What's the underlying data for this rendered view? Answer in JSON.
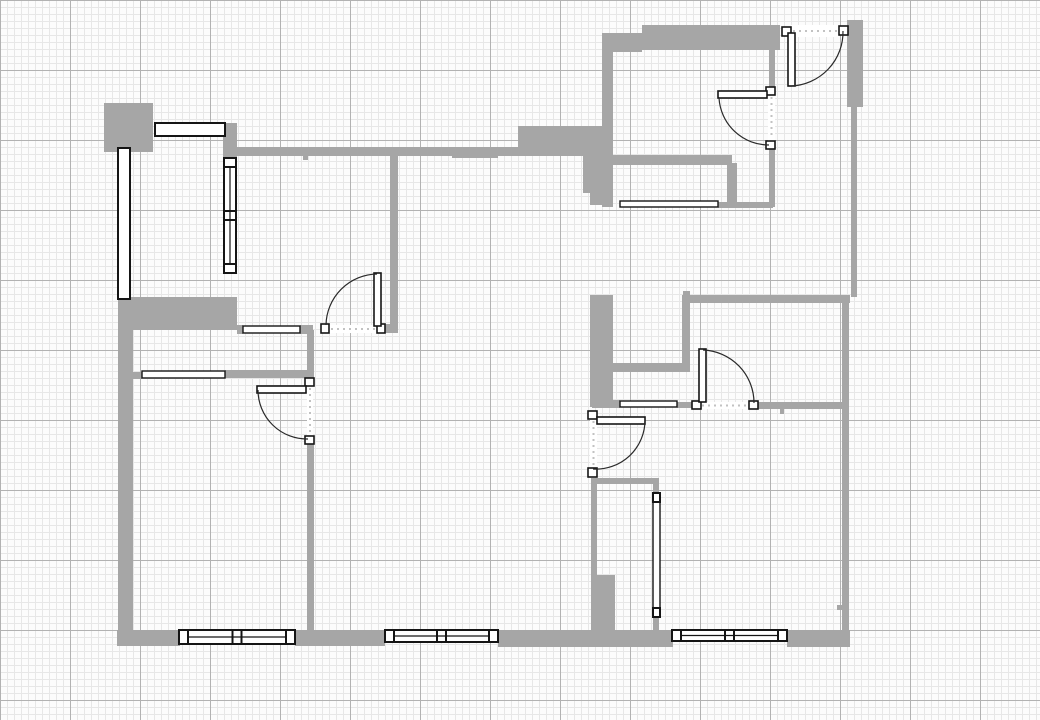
{
  "app": {
    "title": "Floor plan drawing canvas"
  },
  "canvas": {
    "width": 1040,
    "height": 720,
    "background": "#fcfcfc",
    "grid": {
      "minor_spacing": 7,
      "major_spacing": 70,
      "minor_color": "#e7e7e7",
      "major_color": "#b2b2b2"
    }
  },
  "palette": {
    "wall": "#a6a6a6",
    "frame": "#151515",
    "glass": "#ffffff",
    "arc": "#2a2a2a",
    "dash": "#c2c2c2"
  },
  "plan": {
    "walls": [
      [
        104,
        103,
        49,
        49
      ],
      [
        223,
        123,
        14,
        35
      ],
      [
        237,
        147,
        376,
        9
      ],
      [
        518,
        126,
        95,
        22
      ],
      [
        583,
        148,
        27,
        45
      ],
      [
        590,
        193,
        20,
        12
      ],
      [
        602,
        33,
        11,
        174
      ],
      [
        602,
        33,
        40,
        19
      ],
      [
        642,
        25,
        138,
        25
      ],
      [
        847,
        20,
        16,
        87
      ],
      [
        851,
        107,
        6,
        190
      ],
      [
        613,
        155,
        119,
        10
      ],
      [
        727,
        163,
        10,
        41
      ],
      [
        718,
        202,
        55,
        6
      ],
      [
        769,
        37,
        6,
        50
      ],
      [
        769,
        149,
        6,
        58
      ],
      [
        690,
        295,
        160,
        8
      ],
      [
        842,
        303,
        7,
        330
      ],
      [
        682,
        295,
        8,
        77
      ],
      [
        613,
        363,
        69,
        9
      ],
      [
        590,
        295,
        23,
        112
      ],
      [
        118,
        297,
        119,
        33
      ],
      [
        118,
        299,
        15,
        346
      ],
      [
        117,
        630,
        63,
        16
      ],
      [
        295,
        630,
        90,
        16
      ],
      [
        498,
        630,
        175,
        17
      ],
      [
        787,
        630,
        63,
        17
      ],
      [
        237,
        325,
        6,
        9
      ],
      [
        300,
        325,
        13,
        9
      ],
      [
        383,
        324,
        15,
        9
      ],
      [
        390,
        156,
        8,
        169
      ],
      [
        307,
        330,
        7,
        49
      ],
      [
        307,
        443,
        7,
        189
      ],
      [
        225,
        370,
        88,
        8
      ],
      [
        133,
        372,
        9,
        7
      ],
      [
        592,
        400,
        28,
        8
      ],
      [
        677,
        402,
        16,
        6
      ],
      [
        757,
        402,
        85,
        7
      ],
      [
        591,
        478,
        68,
        6
      ],
      [
        591,
        483,
        6,
        92
      ],
      [
        591,
        575,
        24,
        56
      ],
      [
        653,
        484,
        6,
        10
      ],
      [
        653,
        617,
        6,
        14
      ],
      [
        780,
        409,
        4,
        5
      ],
      [
        837,
        605,
        6,
        5
      ],
      [
        303,
        156,
        5,
        4
      ],
      [
        392,
        253,
        5,
        4
      ],
      [
        452,
        155,
        46,
        3
      ],
      [
        683,
        291,
        7,
        5
      ]
    ],
    "windows": [
      {
        "id": "window-balcony-west",
        "style": "plain",
        "rect": [
          118,
          148,
          12,
          151
        ]
      },
      {
        "id": "window-balcony-north",
        "style": "plain",
        "rect": [
          155,
          123,
          70,
          13
        ]
      },
      {
        "id": "window-balcony-inner",
        "style": "glazed",
        "rect": [
          224,
          158,
          12,
          115
        ]
      },
      {
        "id": "window-top-right-room",
        "style": "thin",
        "rect": [
          620,
          201,
          98,
          6
        ]
      },
      {
        "id": "window-mid-right",
        "style": "thin",
        "rect": [
          620,
          401,
          57,
          6
        ]
      },
      {
        "id": "window-mid-left",
        "style": "thin",
        "rect": [
          142,
          371,
          83,
          7
        ]
      },
      {
        "id": "window-hall-pass",
        "style": "thin",
        "rect": [
          243,
          326,
          57,
          7
        ]
      },
      {
        "id": "window-south-left",
        "style": "sash2",
        "rect": [
          179,
          630,
          116,
          14
        ]
      },
      {
        "id": "window-south-middle",
        "style": "sash2",
        "rect": [
          385,
          630,
          113,
          12
        ]
      },
      {
        "id": "window-south-right",
        "style": "sash2",
        "rect": [
          672,
          630,
          115,
          11
        ]
      },
      {
        "id": "window-closet",
        "style": "caps",
        "rect": [
          653,
          493,
          7,
          124
        ]
      }
    ],
    "doors": [
      {
        "id": "door-living-room",
        "opening": [
          329,
          325,
          48,
          8
        ],
        "jambs": [
          [
            321,
            324,
            8,
            9
          ],
          [
            377,
            324,
            8,
            9
          ]
        ],
        "leaf": [
          374,
          273,
          7,
          53
        ],
        "arc": "M 377 274 A 52 52 0 0 0 326 325"
      },
      {
        "id": "door-entry-top",
        "opening": [
          791,
          25,
          48,
          12
        ],
        "jambs": [
          [
            782,
            27,
            9,
            9
          ],
          [
            839,
            26,
            9,
            9
          ]
        ],
        "leaf": [
          788,
          33,
          7,
          53
        ],
        "arc": "M 791 86 A 54 54 0 0 0 843 31"
      },
      {
        "id": "door-top-right-room",
        "opening": [
          768,
          95,
          7,
          46
        ],
        "jambs": [
          [
            766,
            87,
            9,
            8
          ],
          [
            766,
            141,
            9,
            8
          ]
        ],
        "leaf": [
          718,
          91,
          49,
          7
        ],
        "arc": "M 719 98 A 50 50 0 0 0 769 145"
      },
      {
        "id": "door-mid-right-room",
        "opening": [
          700,
          402,
          49,
          7
        ],
        "jambs": [
          [
            692,
            401,
            9,
            8
          ],
          [
            749,
            401,
            9,
            8
          ]
        ],
        "leaf": [
          699,
          349,
          7,
          53
        ],
        "arc": "M 703 350 A 53 53 0 0 1 754 403"
      },
      {
        "id": "door-hall-south",
        "opening": [
          590,
          419,
          7,
          49
        ],
        "jambs": [
          [
            588,
            411,
            9,
            8
          ],
          [
            588,
            468,
            9,
            9
          ]
        ],
        "leaf": [
          597,
          417,
          48,
          7
        ],
        "arc": "M 645 420 A 49 49 0 0 1 593 469"
      },
      {
        "id": "door-bedroom",
        "opening": [
          307,
          386,
          6,
          50
        ],
        "jambs": [
          [
            305,
            378,
            9,
            8
          ],
          [
            305,
            436,
            9,
            8
          ]
        ],
        "leaf": [
          257,
          386,
          49,
          7
        ],
        "arc": "M 258 390 A 49 49 0 0 0 308 439"
      }
    ]
  }
}
